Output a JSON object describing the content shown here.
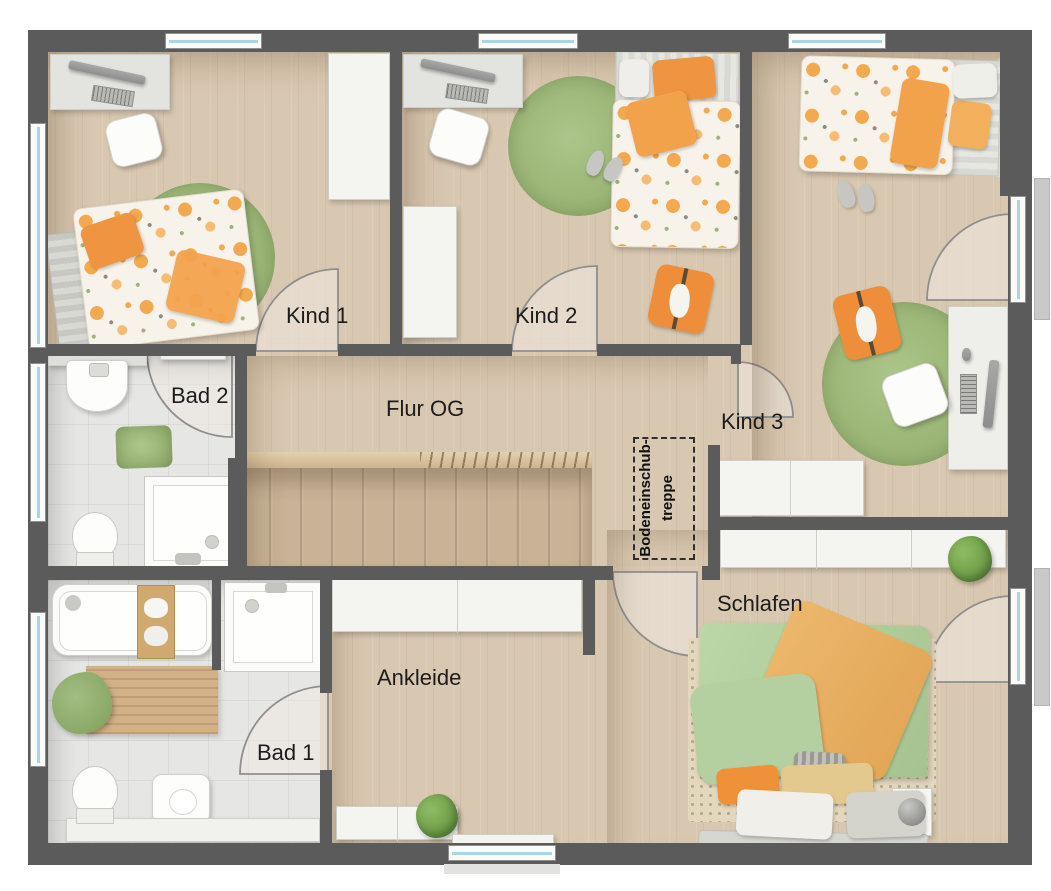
{
  "plan_type": "floor-plan-upper-storey",
  "rooms": {
    "kind1": "Kind 1",
    "kind2": "Kind 2",
    "kind3": "Kind 3",
    "bad2": "Bad 2",
    "flur": "Flur OG",
    "bad1": "Bad 1",
    "ankleide": "Ankleide",
    "schlafen": "Schlafen"
  },
  "attic": {
    "line1": "Bodeneinschub-",
    "line2": "treppe",
    "full_label": "Bodeneinschub-treppe"
  },
  "colors": {
    "wall": "#5b5b5b",
    "wood_floor": "#d9c8b1",
    "tile_floor": "#e6e6e4",
    "stair_wood": "#c8b396",
    "accent_orange": "#ef9440",
    "rug_green": "#97b272",
    "bed_green": "#b5d0a0",
    "blanket_sand": "#e9b164",
    "furniture_white": "#f4f4f1",
    "window_glass": "#abd4e4"
  }
}
